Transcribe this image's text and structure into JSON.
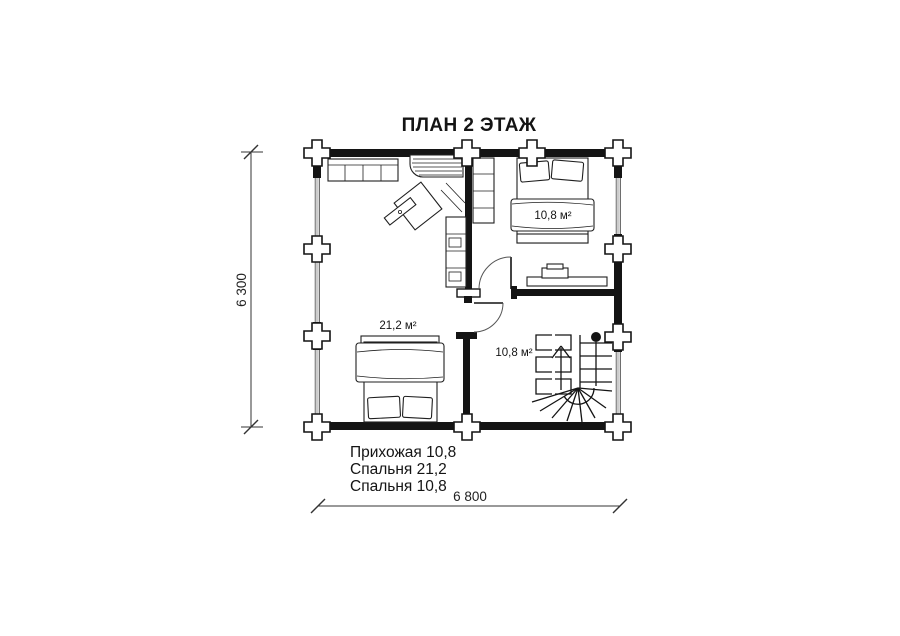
{
  "title": "ПЛАН 2 ЭТАЖ",
  "dimensions": {
    "width_label": "6 800",
    "height_label": "6 300"
  },
  "rooms": [
    {
      "id": "bedroom-upper-right",
      "area_label": "10,8 м²"
    },
    {
      "id": "bedroom-left",
      "area_label": "21,2 м²"
    },
    {
      "id": "hallway-stairs",
      "area_label": "10,8 м²"
    }
  ],
  "legend": {
    "lines": [
      "Прихожая 10,8",
      "Спальня 21,2",
      "Спальня 10,8"
    ]
  },
  "colors": {
    "line": "#141414",
    "background": "#ffffff"
  }
}
